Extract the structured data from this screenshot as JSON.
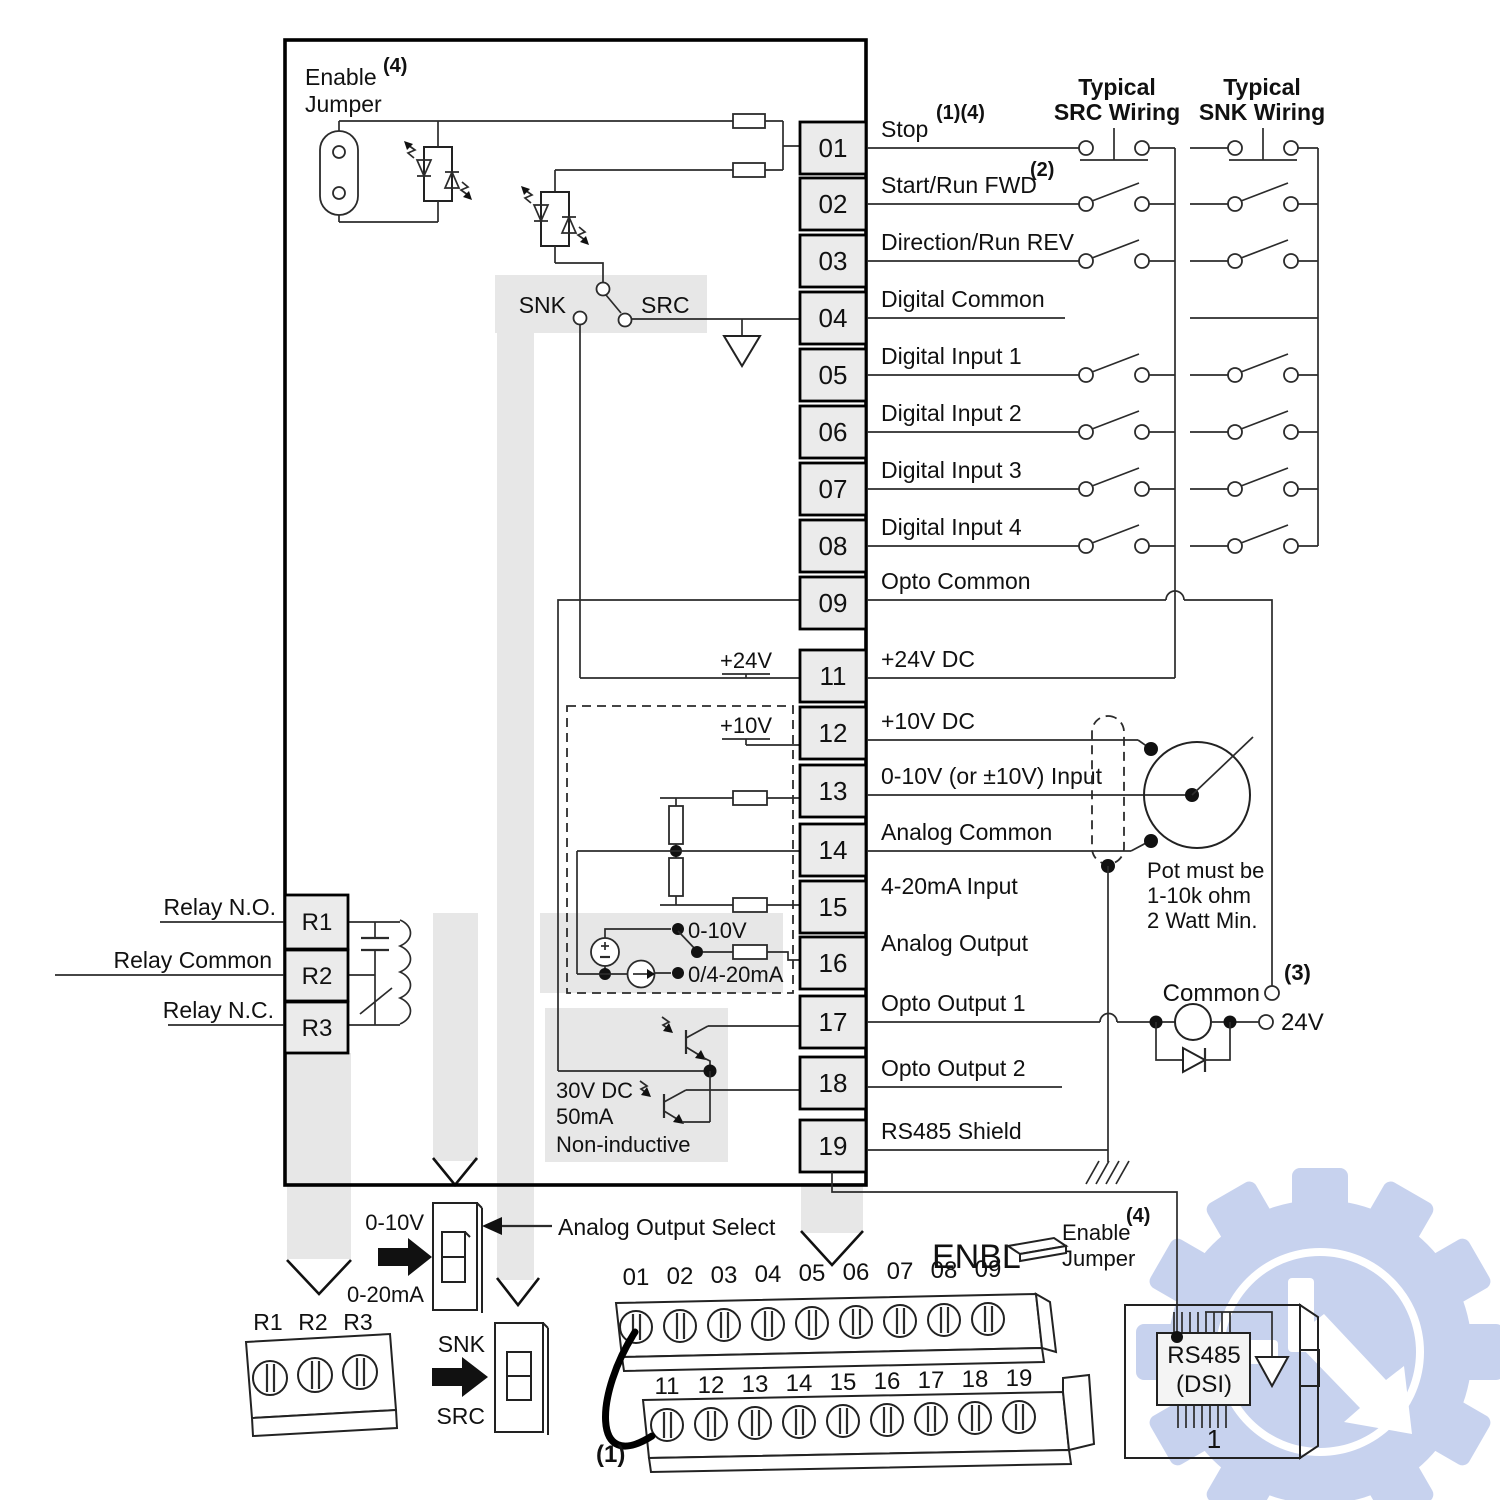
{
  "colors": {
    "line": "#1a1a1a",
    "shade": "#e7e7e7",
    "terminal_fill": "#ebebeb",
    "watermark": "#c5d0ee"
  },
  "drive": {
    "enable_jumper_line1": "Enable",
    "enable_jumper_line2": "Jumper",
    "enable_jumper_note": "(4)",
    "snk": "SNK",
    "src": "SRC",
    "v24_tap": "+24V",
    "v10_tap": "+10V",
    "sel_v": "0-10V",
    "sel_i": "0/4-20mA",
    "opto_spec_1": "30V DC",
    "opto_spec_2": "50mA",
    "opto_spec_3": "Non-inductive"
  },
  "relay": {
    "no": "Relay N.O.",
    "common": "Relay Common",
    "nc": "Relay N.C.",
    "r1": "R1",
    "r2": "R2",
    "r3": "R3"
  },
  "terminals": [
    {
      "n": "01",
      "t": "Stop",
      "s": "(1)(4)"
    },
    {
      "n": "02",
      "t": "Start/Run FWD",
      "s": "(2)"
    },
    {
      "n": "03",
      "t": "Direction/Run REV",
      "s": ""
    },
    {
      "n": "04",
      "t": "Digital Common",
      "s": ""
    },
    {
      "n": "05",
      "t": "Digital Input 1",
      "s": ""
    },
    {
      "n": "06",
      "t": "Digital Input 2",
      "s": ""
    },
    {
      "n": "07",
      "t": "Digital Input 3",
      "s": ""
    },
    {
      "n": "08",
      "t": "Digital Input 4",
      "s": ""
    },
    {
      "n": "09",
      "t": "Opto Common",
      "s": ""
    },
    {
      "n": "11",
      "t": "+24V DC",
      "s": ""
    },
    {
      "n": "12",
      "t": "+10V DC",
      "s": ""
    },
    {
      "n": "13",
      "t": "0-10V (or ±10V) Input",
      "s": ""
    },
    {
      "n": "14",
      "t": "Analog Common",
      "s": ""
    },
    {
      "n": "15",
      "t": "4-20mA Input",
      "s": ""
    },
    {
      "n": "16",
      "t": "Analog Output",
      "s": ""
    },
    {
      "n": "17",
      "t": "Opto Output 1",
      "s": ""
    },
    {
      "n": "18",
      "t": "Opto Output 2",
      "s": ""
    },
    {
      "n": "19",
      "t": "RS485 Shield",
      "s": ""
    }
  ],
  "src_col": {
    "l1": "Typical",
    "l2": "SRC Wiring"
  },
  "snk_col": {
    "l1": "Typical",
    "l2": "SNK Wiring"
  },
  "pot": {
    "l1": "Pot must be",
    "l2": "1-10k ohm",
    "l3": "2 Watt Min."
  },
  "ext": {
    "common": "Common",
    "v24": "24V",
    "note3": "(3)"
  },
  "bottom": {
    "analog_select": "Analog Output Select",
    "sw_analog_top": "0-10V",
    "sw_analog_bottom": "0-20mA",
    "sw_mode_top": "SNK",
    "sw_mode_bottom": "SRC",
    "relay_r1": "R1",
    "relay_r2": "R2",
    "relay_r3": "R3",
    "note1": "(1)",
    "note4": "(4)",
    "enbl": "ENBL",
    "enable_l1": "Enable",
    "enable_l2": "Jumper",
    "rs485_l1": "RS485",
    "rs485_l2": "(DSI)",
    "rs485_pin": "1",
    "strip1": [
      "01",
      "02",
      "03",
      "04",
      "05",
      "06",
      "07",
      "08",
      "09"
    ],
    "strip2": [
      "11",
      "12",
      "13",
      "14",
      "15",
      "16",
      "17",
      "18",
      "19"
    ]
  }
}
